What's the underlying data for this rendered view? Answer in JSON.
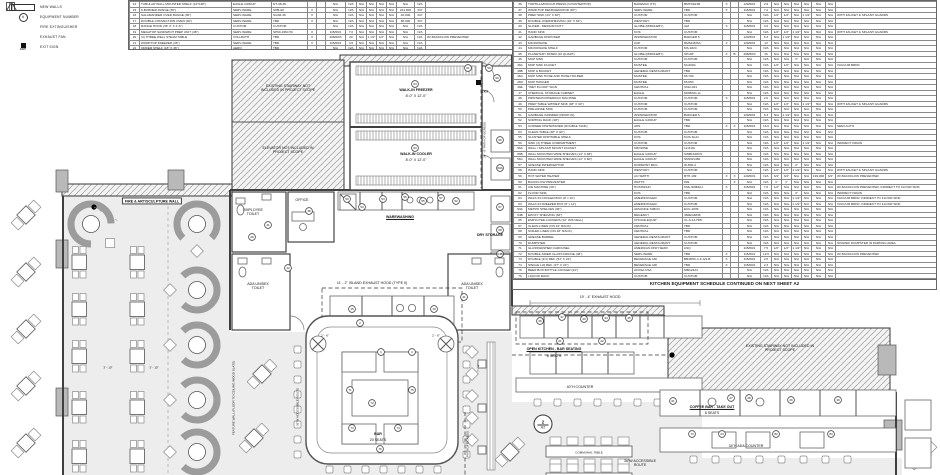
{
  "legend": {
    "items": [
      {
        "icon": "new-wall-swatch",
        "label": "NEW WALLS"
      },
      {
        "icon": "equipment-number-circle",
        "label": "EQUIPMENT NUMBER"
      },
      {
        "icon": "fire-extinguisher-triangle",
        "label": "FIRE EXTINGUISHER"
      },
      {
        "icon": "exhaust-fan-square",
        "label": "EXHAUST FAN"
      },
      {
        "icon": "exit-sign",
        "label": "EXIT SIGN"
      }
    ],
    "exit_icon_text": "EXIT"
  },
  "schedule_left": {
    "rows": [
      "14|TUBULAR WALL MOUNTED SHELF (14\"X48\")|EAGLE GROUP|DT-48-48|||N/A|N/A|N/A|N/A|N/A|N/A|N/A|N/A|",
      "15|6-BURNER RANGE (36\")|SERV-WARE|SHB-60|X||N/A|N/A|N/A|N/A|N/A|N/A|221,000|3/4\"|",
      "16|SALAMANDER OVER RANGE (36\")|SERV-WARE|SGS6-36|X||N/A|N/A|N/A|N/A|N/A|N/A|40,000|3/4\"|",
      "17|DOUBLE CONVECTION OVEN (40\")|SERV-WARE|TBD|X||N/A|N/A|N/A|N/A|N/A|N/A|80,000|3/4\"|",
      "18|RANGE HOOD (36' 4\" X 4'-6\")|CUSTOM|CUSTOM|||N/A|N/A|N/A|N/A|N/A|N/A|N/A|N/A|",
      "19|MEGATOP SANDWICH PREP UNIT (48\")|SERV-WARE|SP60-16M-HC|X||115/60/1|7.0|N/A|N/A|N/A|N/A|N/A|N/A|",
      "20|(3) THREE WELL STEAM TABLE|VOLLRATH|TBD|X||208/60/3|20|N/A|1 1/2\"|1/2\"|N/A|N/A|N/A|W/ BACKFLOW PREVENTER",
      "21|WORKTOP FREEZER (36\")|SERV-WARE|TBD|X||115/60/1|4.5|N/A|N/A|N/A|N/A|N/A|N/A|",
      "22|ORDER SHELF (18\" X 36\")|AERO|TBD|||N/A|N/A|N/A|N/A|N/A|N/A|N/A|N/A|"
    ]
  },
  "schedule_right": {
    "rows": [
      "36|TORTILLA/DOUGH PRESS (COUNTERTOP)|BAKEMAX (TX)|BMTXE21B|X||120/60/1|2.9|N/A|N/A|N/A|N/A|N/A|N/A|",
      "37|WORKTOP REFRIGERATOR (60\")|SERV-WARE|TBD|X||115/60/1|7.2|N/A|N/A|N/A|N/A|N/A|N/A|",
      "38|PREP SINK (24\" X 30\")|CUSTOM|CUSTOM|||N/A|N/A|1/2\"|1/2\"|N/A|1 1/2\"|N/A|N/A|WITH FAUCET & SPLASH GUARDS",
      "39|DOUBLE OVERSHELVING (16\" X 84\")|WESTORY|TBD|||N/A|N/A|N/A|N/A|N/A|N/A|N/A|N/A|",
      "40|SLICER - MEDIUM DUTY|GLOBE (MIDDLEBY)|GM|X||115/60/1|4.6|N/A|N/A|N/A|N/A|N/A|N/A|",
      "41|HAND SINK|KOS|CUSTOM|||N/A|N/A|1/2\"|1/2\"|1 1/2\"|N/A|N/A|N/A|WITH FAUCET & SPLASH GUARDS",
      "42|GARBAGE DISPOSER|INSINKERATOR|BADGER 5|||120/60/1|6.3|N/A|1 1/2\"|N/A|N/A|N/A|N/A|",
      "43|MICROWAVE|ACP|RMS10DSA|X||120/60/1|13|N/A|N/A|N/A|N/A|N/A|N/A|",
      "44|MICROWAVE SHELF|CUSTOM|MS-1824|||N/A|N/A|N/A|N/A|N/A|N/A|N/A|N/A|",
      "45|PLANETARY MIXER (10 QUART)|GLOBE (MIDDLEBY)|SP10P|X|B|208/60/3|16|N/A|N/A|N/A|N/A|N/A|N/A|",
      "46|MOP SINK|CUSTOM|CUSTOM|||N/A|N/A|N/A|N/A|3\"|N/A|N/A|N/A|",
      "46A|MOP SINK FAUCET|MUSTEE|63-600A|||N/A|N/A|1/2\"|1/2\"|N/A|N/A|N/A|N/A|VACUUM BRKR.",
      "46B|MOP & BUCKET|GENERAL RESTAURANT|TBD|||N/A|N/A|N/A|N/A|N/A|N/A|N/A|N/A|",
      "46C|MOP SINK HOSE AND HOSE HOLDER|MUSTEE|65.700|||N/A|N/A|N/A|N/A|N/A|N/A|N/A|N/A|",
      "46D|MOP HANGER|MUSTEE|65.650|||N/A|N/A|N/A|N/A|N/A|N/A|N/A|N/A|",
      "46E|\"WET FLOOR\" SIGN|CENTRAL|3312-021|||N/A|N/A|N/A|N/A|N/A|N/A|N/A|N/A|",
      "47|CHEMICAL STORAGE CABINET|EAGLE|MORING-LL|||N/A|N/A|N/A|N/A|N/A|N/A|N/A|N/A|",
      "48|PRINTER/COPIER/FAX MACHINE|CUSTOM|CUSTOM|X||115/60/1|2.0|N/A|N/A|N/A|N/A|N/A|N/A|",
      "49|PREP TABLE W/PREP SINK (48\" X 30\")|CUSTOM|CUSTOM|||N/A|N/A|1/2\"|1/2\"|N/A|1 1/2\"|N/A|N/A|WITH FAUCET & SPLASH GUARDS",
      "50|PRE-RINSE SINK|CUSTOM|CUSTOM|||N/A|N/A|N/A|N/A|N/A|N/A|N/A|N/A|",
      "51|GARBAGE GRINDER (DROP-IN)|INSINKERATOR|BADGER 5|||120/60/1|6.3|N/A|1 1/2\"|N/A|N/A|N/A|N/A|",
      "52|SORTING RACK (48\")|EAGLE GROUP|TBD|||N/A|N/A|N/A|N/A|N/A|N/A|N/A|N/A|",
      "53|CORNER DISHWASHER (DOUBLE TANK)|ADS|TBD|X|X|115/60/1|16.6|N/A|N/A|N/A|N/A|N/A|N/A|SEMI-AUTO",
      "54|CLEAN TABLE (48\" X 30\")|CUSTOM|CUSTOM|||N/A|N/A|N/A|N/A|N/A|N/A|N/A|N/A|",
      "55|SLANTED DISHTABLE SHELF|KOS|KOS-SL21|||N/A|N/A|N/A|N/A|N/A|N/A|N/A|N/A|",
      "56|SINK (3) THREE COMPARTMENT|CUSTOM|CUSTOM|||N/A|N/A|1/2\"|1/2\"|N/A|1 1/2\"|N/A|N/A|INDIRECT DRAIN",
      "56A|WALL / SPLASH MOUNT FAUCET|KROWNE|12-810L|||N/A|N/A|N/A|N/A|N/A|N/A|N/A|N/A|",
      "56B|WALL MOUNTED WIRE SHELVES (14\" X 48\")|EAGLE GROUP|SWB1448VS|||N/A|N/A|N/A|N/A|N/A|N/A|N/A|N/A|",
      "56C|WALL MOUNTED WIRE SHELVES (14\" X 60\")|EAGLE GROUP|SNSW1460|||N/A|N/A|N/A|N/A|N/A|N/A|N/A|N/A|",
      "57|GREASE INTERCEPTOR|DORMONT MFG|W-500-A|||N/A|N/A|N/A|N/A|2\"|N/A|N/A|N/A|",
      "58|HAND SINK|WESTORY|CUSTOM|||N/A|N/A|1/2\"|1/2\"|1 1/2\"|N/A|N/A|N/A|WITH FAUCET & SPLASH GUARDS",
      "59|HOT WATER HEATER|AO SMITH|BTH-199|X|X|120/60/1|N/A|3/4\"|3/4\"|N/A|N/A|199,000|3/4\"|W/ BACKFLOW PREVENTER",
      "60|BACKFLOW PREVENTER|WATTS|909||X|N/A|N/A|1\"|1\"|N/A|N/A|N/A|N/A|",
      "61|ICE MACHINE (30\")|HOSHIZAKI|KML-500MAJ|X||115/60/1|7.6|1/2\"|N/A|N/A|N/A|N/A|N/A|W/ BACKFLOW PREVENTER, INDIRECT TO FLOOR SINK",
      "62|FLOOR SINK|KOS|TBD|||N/A|N/A|N/A|N/A|3\"|N/A|N/A|N/A|INDIRECT DRAIN",
      "63|WALK-IN COOLER BOX (8' x 10')|AMERIKOOLER|CUSTOM|||N/A|N/A|N/A|N/A|1 1/2\"|N/A|N/A|N/A|VACUUM BRKR, INDIRECT TO FLOOR SINK",
      "64|WALK-IN FREEZER BOX (8' x 12')|AMERIKOOLER|CUSTOM|||N/A|N/A|N/A|N/A|1 1/2\"|N/A|N/A|N/A|VACUUM BRKR, INDIRECT TO FLOOR SINK",
      "63A|METRO SHELVES (36\")|ADVANCE TABCO|ECC-1836|||N/A|N/A|N/A|N/A|N/A|N/A|N/A|N/A|",
      "64B|EPOXY SHELVING (36\")|REGENCY|460EG6836|||N/A|N/A|N/A|N/A|N/A|N/A|N/A|N/A|",
      "66|EMPLOYEE LOCKERS (12\" W/6 CELL)|CHOICE EQUIP|CL-6-12-HPF|||N/A|N/A|N/A|N/A|N/A|N/A|N/A|N/A|",
      "67|CLEAN LINEN (ON 24\" RACK)|CENTRAL|TBD|||N/A|N/A|N/A|N/A|N/A|N/A|N/A|N/A|",
      "68|SOILED LINEN (ON 18\" RACK)|CENTRAL|TBD|||N/A|N/A|N/A|N/A|N/A|N/A|N/A|N/A|",
      "69|GREASE BARREL|GENERAL RESTAURANT|CUSTOM|||N/A|N/A|N/A|N/A|N/A|N/A|N/A|N/A|",
      "70|DUMPSTER|GENERAL RESTAURANT|CUSTOM|||N/A|N/A|N/A|N/A|N/A|N/A|N/A|N/A|SHARED DUMPSTER IN PARKING AREA",
      "71|GLASSWASHER CAROUSEL|AMERICAN DISH SERV.|ASQ|||115/60/1|7.5|1/2\"|1/2\"|1 1/2\"|N/A|N/A|N/A|",
      "72|DOUBLE-SIDED GLASS FRIDGE (48\")|SERV-WARE|TBD|X||115/60/1|12.6|N/A|N/A|N/A|N/A|N/A|N/A|W/ BACKFLOW PREVENTER",
      "73|DOUBLE (2/1) REF. (54\" X 24\")|BEVERAGE AIR|BB48HC-1-F-GS-B|X||115/60/1|2.5|N/A|N/A|N/A|N/A|N/A|N/A|",
      "74|SINGLE LIQ REF. (27\" X 24\")|BEVERAGE AIR|TBD|X||115/60/1|2.3|N/A|N/A|N/A|N/A|N/A|N/A|",
      "75|BEER BOX BOTTLE COOLER (24\")|AFOSA USA|MBC2424|||N/A|N/A|N/A|N/A|N/A|N/A|N/A|N/A|",
      "76|LIQUOR RACK|CUSTOM|CUSTOM|||N/A|N/A|N/A|N/A|N/A|N/A|N/A|N/A|"
    ],
    "footer": "KITCHEN EQUIPMENT SCHEDULE CONTINUED ON NEXT SHEET A2"
  },
  "plan": {
    "labels": {
      "fire_wall": "FIRE & ART/SCULPTURE WALL",
      "stairway": "EXISTING STAIRWAY NOT INCLUDED IN PROJECT SCOPE",
      "elevator": "ELEVATOR NOT INCLUDED IN PROJECT SCOPE",
      "stairway2": "EXISTING STAIRWAY NOT INCLUDED IN PROJECT SCOPE",
      "freezer_t": "WALK-IN FREEZER",
      "freezer_d": "8'-0\" X 12'-0\"",
      "cooler_t": "WALK-IN COOLER",
      "cooler_d": "8'-0\" X 12'-0\"",
      "employee_toilet": "EMPLOYEE TOILET",
      "office": "OFFICE",
      "warewashing": "WAREWASHING",
      "dry_storage": "DRY STORAGE",
      "ada_toilet": "ADA UNISEX TOILET",
      "island_hood": "11' - 2\" ISLAND EXHAUST HOOD (TYPE II)",
      "exhaust_hood": "19' - 4\" EXHAUST HOOD",
      "bar_t": "BAR",
      "bar_d": "20 SEATS",
      "open_kitchen": "OPEN KITCHEN - BAR SEATING",
      "open_kitchen_d": "8 SEATS",
      "counter40": "40\"H COUNTER",
      "coffee_bar": "COFFEE BAR - TAKE OUT",
      "coffee_bar_d": "8 SEATS",
      "ada_counter": "34\"H ADA COUNTER",
      "route36": "36\"W ACCESSIBLE ROUTE",
      "egress": "PATH OF EGRESS",
      "egress34": "34' - 0\" PATH OF EGRESS",
      "communal": "COMMUNAL TABLE",
      "exit": "EXIT",
      "feature_wall": "FEATURE WALL (FLOOR TO CEILING WOOD SLATS)",
      "dim_3_10": "3' - 10\"",
      "dim_2_6": "2' - 6\"",
      "dim_7_4": "7' - 4\"",
      "section_no": "2",
      "section_sheet": "A2"
    },
    "markers": [
      {
        "n": "64",
        "x": 415,
        "y": 84
      },
      {
        "n": "63",
        "x": 415,
        "y": 148
      },
      {
        "n": "59",
        "x": 489,
        "y": 68
      },
      {
        "n": "61",
        "x": 468,
        "y": 68
      },
      {
        "n": "60",
        "x": 497,
        "y": 78
      },
      {
        "n": "66",
        "x": 500,
        "y": 140
      },
      {
        "n": "63A",
        "x": 500,
        "y": 168
      },
      {
        "n": "67",
        "x": 500,
        "y": 207
      },
      {
        "n": "68",
        "x": 500,
        "y": 230
      },
      {
        "n": "64B",
        "x": 500,
        "y": 254
      },
      {
        "n": "50",
        "x": 347,
        "y": 199
      },
      {
        "n": "53",
        "x": 362,
        "y": 207
      },
      {
        "n": "54",
        "x": 383,
        "y": 199
      },
      {
        "n": "56",
        "x": 405,
        "y": 197
      },
      {
        "n": "55",
        "x": 423,
        "y": 201
      },
      {
        "n": "57",
        "x": 441,
        "y": 198
      },
      {
        "n": "52",
        "x": 456,
        "y": 201
      },
      {
        "n": "48",
        "x": 309,
        "y": 211
      },
      {
        "n": "46",
        "x": 252,
        "y": 237
      },
      {
        "n": "41",
        "x": 268,
        "y": 225
      },
      {
        "n": "42",
        "x": 288,
        "y": 268
      },
      {
        "n": "41",
        "x": 464,
        "y": 297
      },
      {
        "n": "15",
        "x": 352,
        "y": 309
      },
      {
        "n": "2",
        "x": 360,
        "y": 323
      },
      {
        "n": "1",
        "x": 381,
        "y": 352
      },
      {
        "n": "4",
        "x": 412,
        "y": 352
      },
      {
        "n": "19",
        "x": 434,
        "y": 309
      },
      {
        "n": "71",
        "x": 350,
        "y": 390
      },
      {
        "n": "72",
        "x": 372,
        "y": 403
      },
      {
        "n": "73",
        "x": 352,
        "y": 428
      },
      {
        "n": "74",
        "x": 398,
        "y": 428
      },
      {
        "n": "75",
        "x": 412,
        "y": 390
      },
      {
        "n": "76",
        "x": 380,
        "y": 449
      },
      {
        "n": "36",
        "x": 540,
        "y": 321
      },
      {
        "n": "37",
        "x": 562,
        "y": 317
      },
      {
        "n": "40",
        "x": 584,
        "y": 319
      },
      {
        "n": "43",
        "x": 606,
        "y": 318
      },
      {
        "n": "45",
        "x": 629,
        "y": 318
      },
      {
        "n": "21",
        "x": 560,
        "y": 341
      },
      {
        "n": "22",
        "x": 602,
        "y": 341
      },
      {
        "n": "61",
        "x": 673,
        "y": 401
      },
      {
        "n": "27",
        "x": 731,
        "y": 398
      },
      {
        "n": "28",
        "x": 749,
        "y": 398
      },
      {
        "n": "29",
        "x": 791,
        "y": 400
      },
      {
        "n": "30",
        "x": 838,
        "y": 400
      },
      {
        "n": "73",
        "x": 692,
        "y": 434
      },
      {
        "n": "24",
        "x": 722,
        "y": 434
      },
      {
        "n": "82",
        "x": 776,
        "y": 434
      },
      {
        "n": "83",
        "x": 831,
        "y": 434
      }
    ]
  }
}
